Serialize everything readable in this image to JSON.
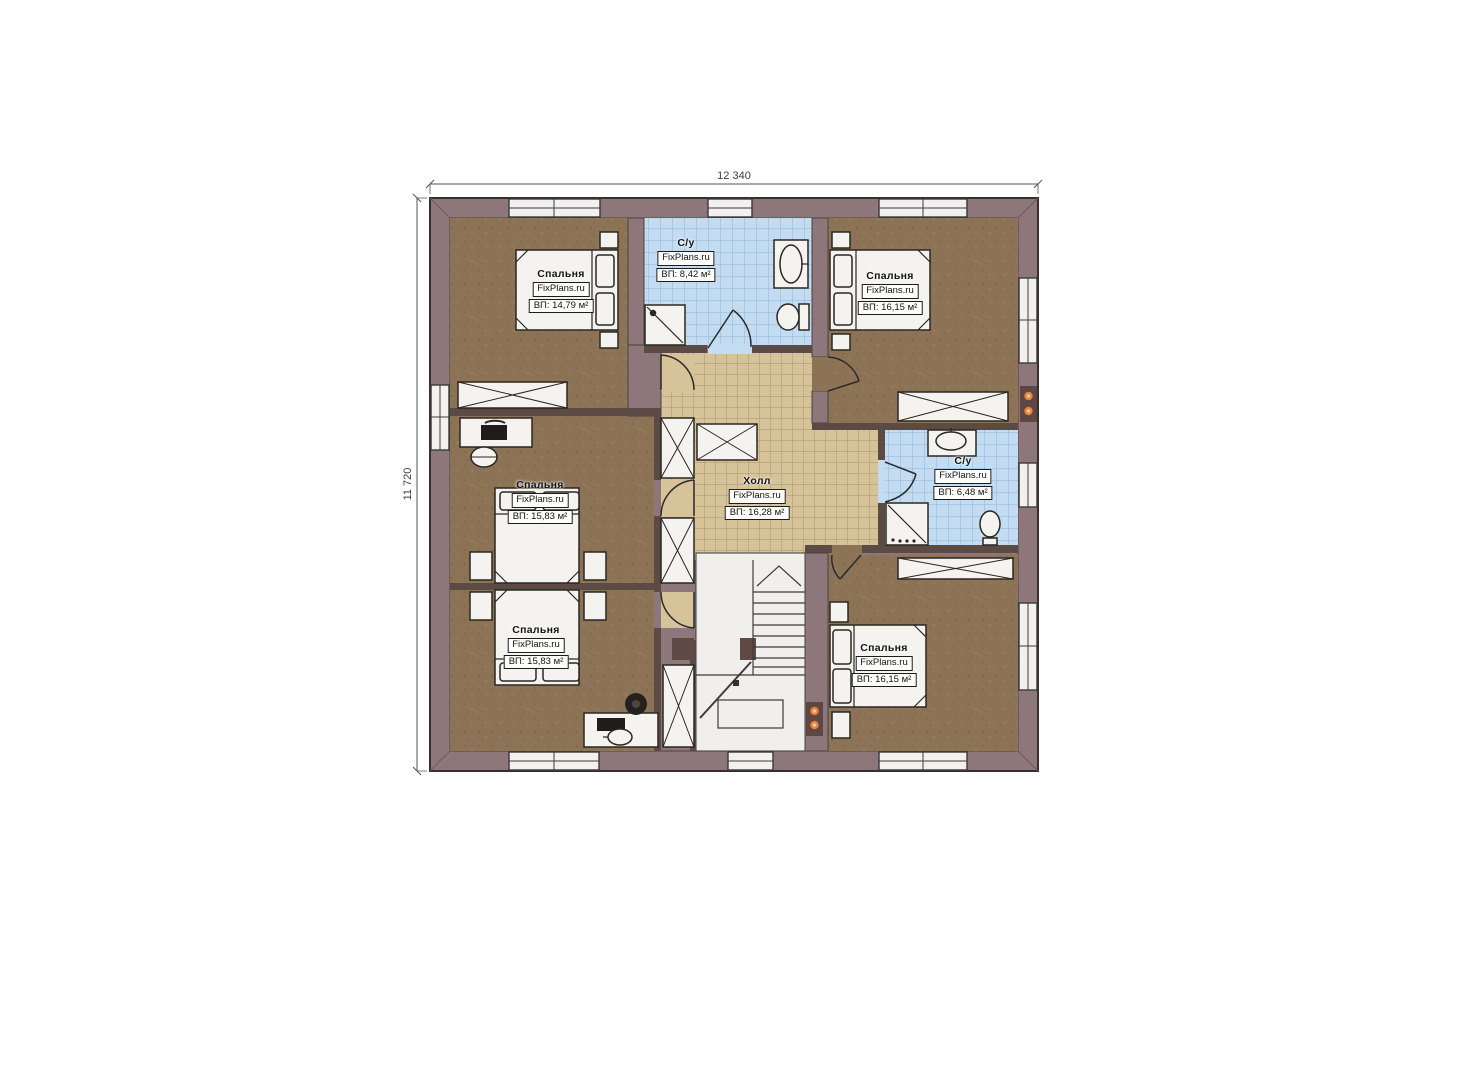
{
  "plan": {
    "dimensions": {
      "width_label": "12 340",
      "height_label": "11 720"
    },
    "rooms": [
      {
        "id": "bedroom-top-left",
        "name": "Спальня",
        "brand": "FixPlans.ru",
        "area": "ВП: 14,79 м²"
      },
      {
        "id": "bathroom-top",
        "name": "С/у",
        "brand": "FixPlans.ru",
        "area": "ВП: 8,42 м²"
      },
      {
        "id": "bedroom-top-right",
        "name": "Спальня",
        "brand": "FixPlans.ru",
        "area": "ВП: 16,15 м²"
      },
      {
        "id": "bedroom-middle-left",
        "name": "Спальня",
        "brand": "FixPlans.ru",
        "area": "ВП: 15,83 м²"
      },
      {
        "id": "hall",
        "name": "Холл",
        "brand": "FixPlans.ru",
        "area": "ВП: 16,28 м²"
      },
      {
        "id": "bathroom-right",
        "name": "С/у",
        "brand": "FixPlans.ru",
        "area": "ВП: 6,48 м²"
      },
      {
        "id": "bedroom-bottom-left",
        "name": "Спальня",
        "brand": "FixPlans.ru",
        "area": "ВП: 15,83 м²"
      },
      {
        "id": "bedroom-bottom-right",
        "name": "Спальня",
        "brand": "FixPlans.ru",
        "area": "ВП: 16,15 м²"
      }
    ],
    "colors": {
      "wall": "#8d777b",
      "inner_wall": "#5c4a45",
      "bedroom_floor": "#8c7355",
      "hall_tile": "#d7c399",
      "bath_tile": "#c3dcf2",
      "furniture": "#f4f3f0",
      "heater_dot": "#e8813f"
    }
  }
}
